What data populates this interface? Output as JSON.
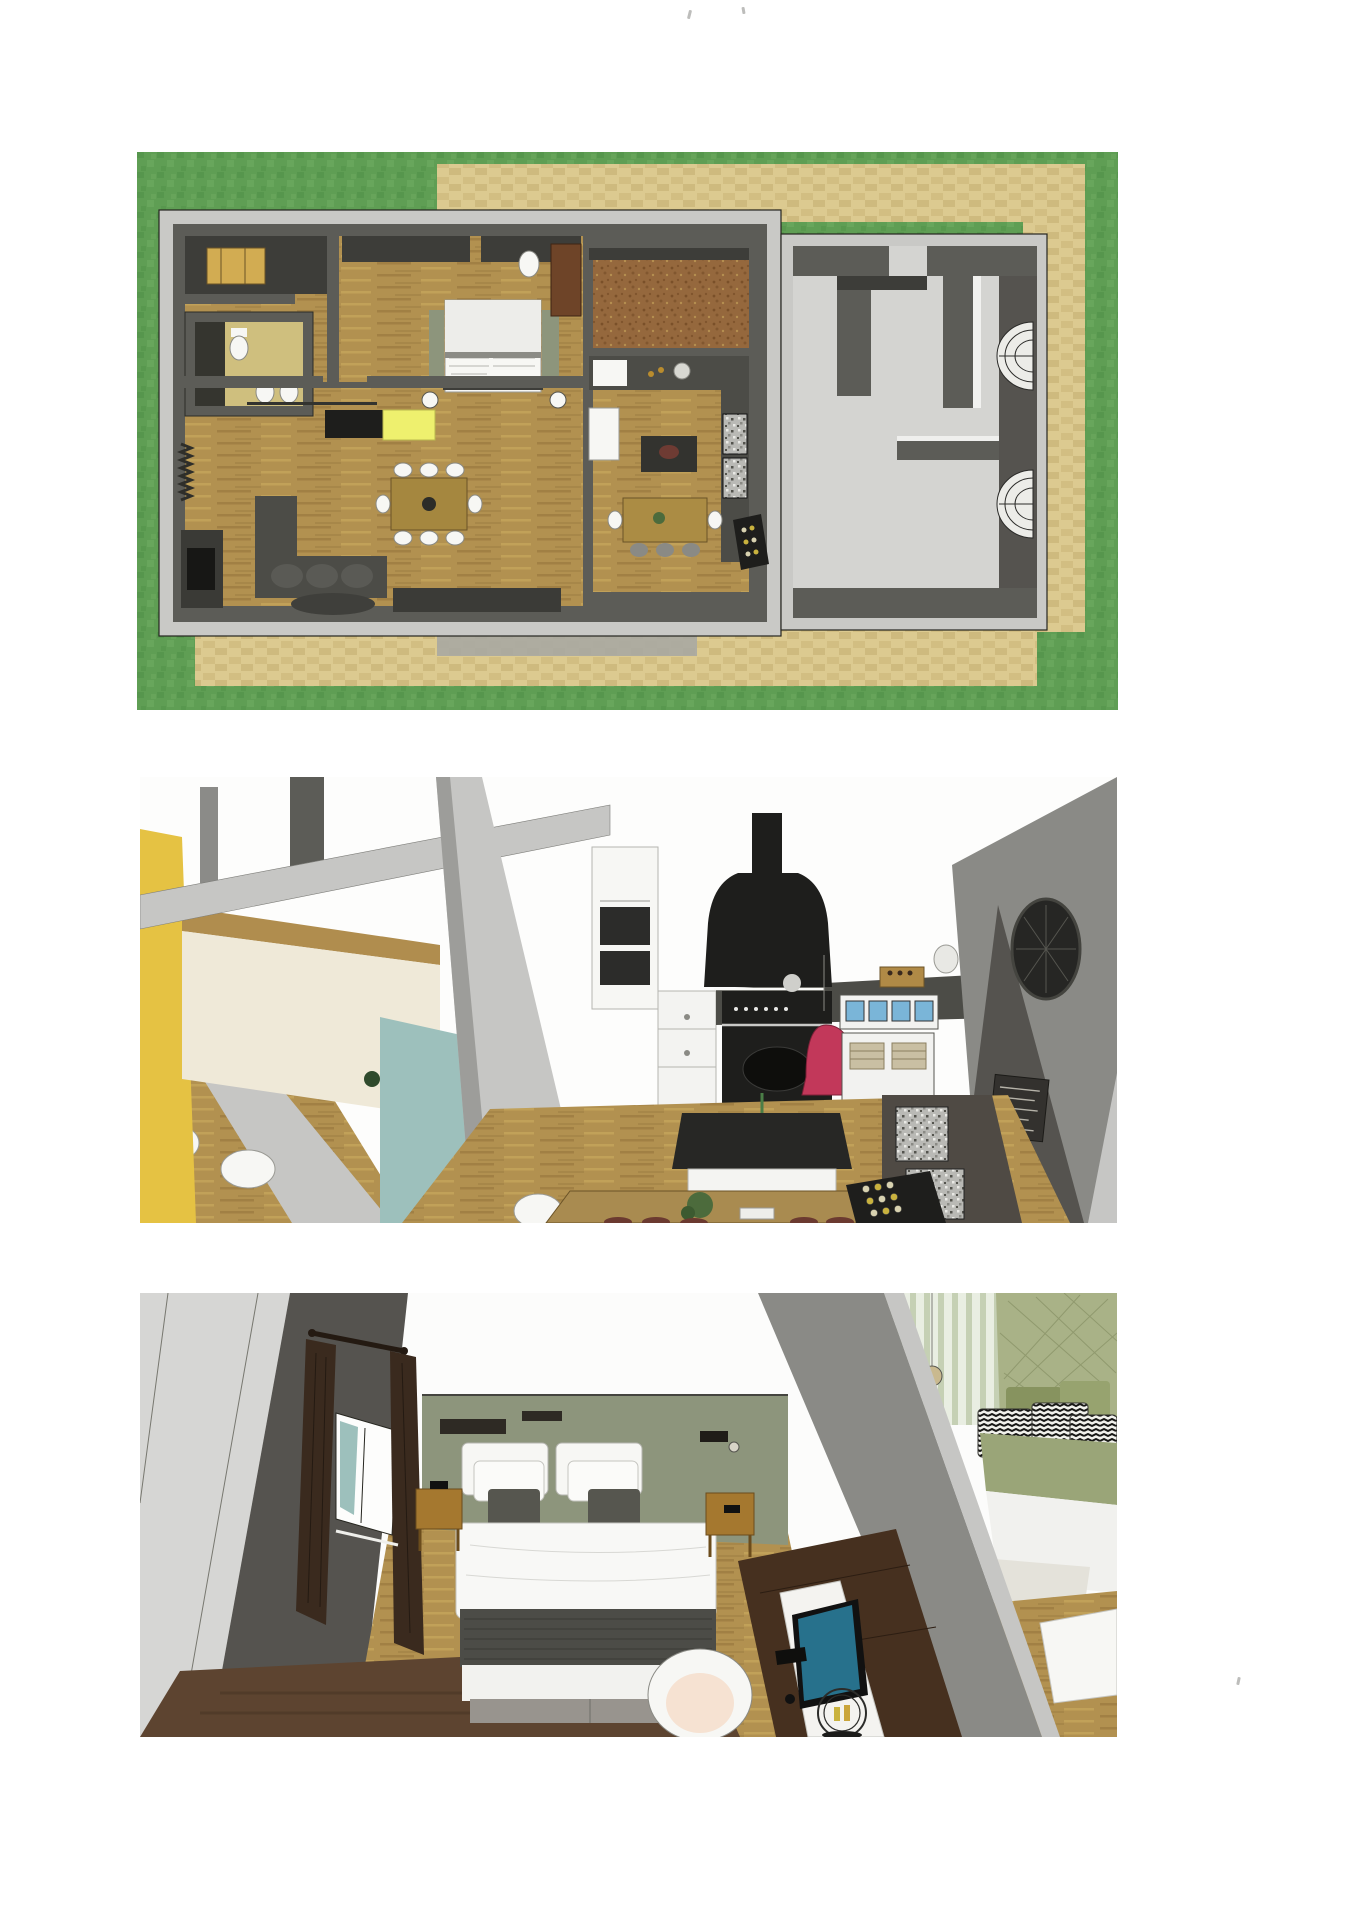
{
  "page": {
    "background": "#ffffff"
  },
  "panels": [
    {
      "name": "site-floor-plan-top-view"
    },
    {
      "name": "kitchen-interior-view"
    },
    {
      "name": "bedroom-interior-view"
    }
  ],
  "colors": {
    "paper": "#ffffff",
    "grass": "#5f9e54",
    "grassDark": "#4e8e45",
    "grassLight": "#72ad63",
    "paver": "#dcca90",
    "paverDark": "#c3ad6e",
    "paverGray": "#a8a8a2",
    "wallLight": "#c9c9c6",
    "wallDark": "#5c5c57",
    "wallDarker": "#3d3d39",
    "garageFloor": "#d4d4d1",
    "wood": "#b29150",
    "woodDark": "#8f7038",
    "woodLight": "#c9a95e",
    "cork": "#95683d",
    "corkDark": "#7a5029",
    "tile": "#cfbf7e",
    "white": "#f7f7f4",
    "blackish": "#1e1e1c",
    "charcoal": "#2c2c2a",
    "sofaDark": "#4c4c47",
    "yellowRug": "#eef06e",
    "yellowCab": "#e5c243",
    "cream": "#efe9d8",
    "teal": "#9dc0bc",
    "redLamp": "#c2385a",
    "screenBlue": "#7ab5d8",
    "tvBlue": "#27718c",
    "sage": "#8d957c",
    "sofaGreen": "#a9b287",
    "sofaGreenDark": "#87935f",
    "seatGreen": "#9aa578",
    "curtainBrown": "#3a2a1e",
    "deskBrown": "#46301f",
    "rugBrown": "#5d4430",
    "nightWood": "#a5782f",
    "graySoft": "#c6c6c4",
    "grayMid": "#9a9a97",
    "grayWall": "#8a8a86",
    "grayDeep": "#55534f",
    "basket": "#c9bfa3",
    "skin": "#f6e2d2",
    "crate": "#b08a46",
    "bottleYellow": "#c9b23e"
  }
}
